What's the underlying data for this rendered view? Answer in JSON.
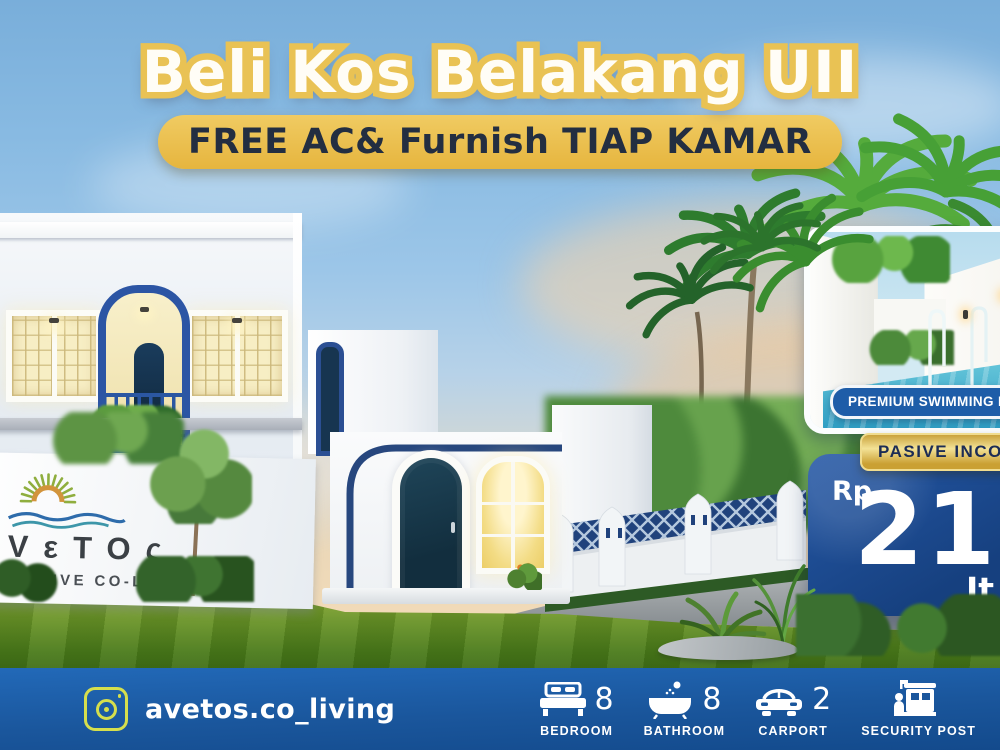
{
  "header": {
    "title": "Beli Kos Belakang UII",
    "promo": "FREE AC& Furnish TIAP KAMAR"
  },
  "signboard": {
    "logo_icon": "sun-waves-logo-icon",
    "brand": "ΛVεTOς",
    "tagline": "EXCLUSIVE CO-LIVING",
    "tagline_mark": "✦"
  },
  "pool_card": {
    "badge_label": "PREMIUM SWIMMING POOL"
  },
  "offer": {
    "badge_label": "PASIVE INCOME",
    "currency": "Rp",
    "amount": "216",
    "unit": "Jt"
  },
  "footer": {
    "instagram_icon": "instagram-icon",
    "instagram_handle": "avetos.co_living",
    "features": [
      {
        "icon": "bed-icon",
        "count": "8",
        "label": "BEDROOM"
      },
      {
        "icon": "bathtub-icon",
        "count": "8",
        "label": "BATHROOM"
      },
      {
        "icon": "car-icon",
        "count": "2",
        "label": "CARPORT"
      },
      {
        "icon": "guard-post-icon",
        "count": "",
        "label": "SECURITY POST"
      }
    ]
  },
  "colors": {
    "accent_gold": "#e9c254",
    "navy_trim": "#2b57a2",
    "footer_blue": "#1a569c",
    "price_card_blue": "#1d4c96",
    "pool_badge_blue": "#1e5da8",
    "badge_text_navy": "#1c2c55",
    "grass_green": "#5c8423",
    "instagram_accent": "#d6df4d"
  }
}
